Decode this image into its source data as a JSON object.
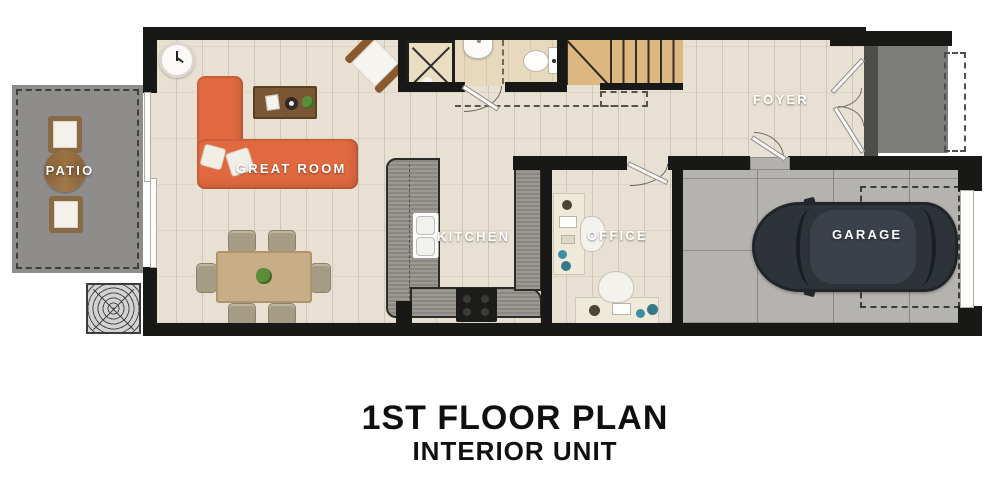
{
  "plan": {
    "rooms": {
      "patio": {
        "label": "PATIO"
      },
      "great_room": {
        "label": "GREAT ROOM"
      },
      "kitchen": {
        "label": "KITCHEN"
      },
      "office": {
        "label": "OFFICE"
      },
      "foyer": {
        "label": "FOYER"
      },
      "garage": {
        "label": "GARAGE"
      }
    },
    "colors": {
      "wall": "#181816",
      "wood_floor": "#e8e0d2",
      "bath_floor": "#e7d9bd",
      "patio_concrete": "#8e8d8b",
      "porch_concrete": "#7c7c7a",
      "garage_concrete": "#b5b3af",
      "sofa_orange": "#e0693f",
      "counter_gray": "#94918a",
      "stairs_wood": "#dcb77f",
      "car_charcoal": "#2e333a",
      "dining_wood": "#c8ae86",
      "coffee_table_wood": "#7a5634",
      "label_text": "#ffffff",
      "title_text": "#0f0f0f"
    },
    "fixtures": [
      "wall-clock",
      "sectional-sofa",
      "coffee-table",
      "accent-chair",
      "dining-table",
      "dining-chairs",
      "kitchen-sink",
      "range",
      "bath-shower",
      "bath-sink",
      "toilet",
      "stairs",
      "office-desks",
      "office-chairs",
      "patio-chairs",
      "patio-table",
      "ac-unit",
      "car",
      "entry-double-door",
      "garage-door",
      "sliding-patio-door"
    ]
  },
  "title": {
    "line1": "1ST FLOOR PLAN",
    "line2": "INTERIOR UNIT"
  }
}
